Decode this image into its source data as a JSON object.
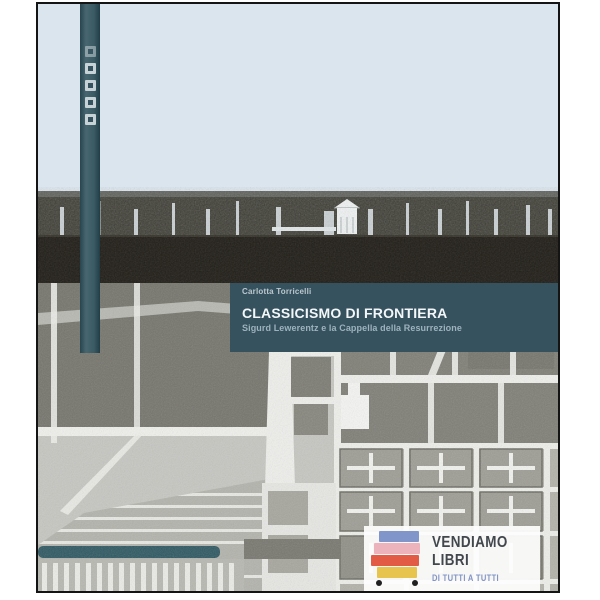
{
  "cover": {
    "author": "Carlotta Torricelli",
    "title": "CLASSICISMO DI FRONTIERA",
    "subtitle": "Sigurd Lewerentz e la Cappella della Resurrezione",
    "colors": {
      "sky": "#dbe5ee",
      "title_band": "#36525f",
      "spine_strip": "#3a5a64",
      "ground": "#201d17",
      "accent_bar": "#2d5761",
      "frame_border": "#141414"
    }
  },
  "watermark": {
    "line1": "VENDIAMO",
    "line2": "LIBRI",
    "tagline": "DI TUTTI A TUTTI",
    "stripe_colors": [
      "#8095c9",
      "#ecb3bd",
      "#e25b45",
      "#e6c44e"
    ],
    "text_color": "#41474c",
    "tagline_color": "#8294c6"
  }
}
